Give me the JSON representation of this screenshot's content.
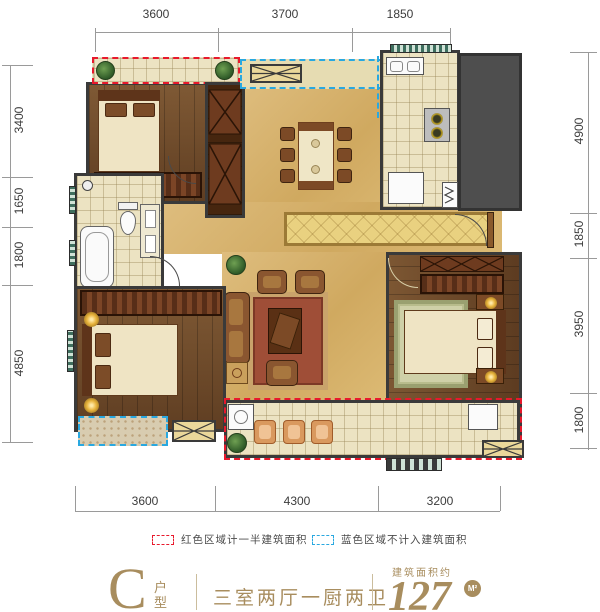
{
  "dimensions": {
    "top": [
      "3600",
      "3700",
      "1850"
    ],
    "left": [
      "3400",
      "1650",
      "1800",
      "4850"
    ],
    "right": [
      "4900",
      "1850",
      "3950",
      "1800"
    ],
    "bottom": [
      "3600",
      "4300",
      "3200"
    ]
  },
  "legend": {
    "red_label": "红色区域计一半建筑面积",
    "blue_label": "蓝色区域不计入建筑面积",
    "red_color": "#e8192c",
    "blue_color": "#29a8e0"
  },
  "title": {
    "letter": "C",
    "letter_suffix": "户型",
    "rooms": "三室两厅一厨两卫",
    "area_label": "建筑面积约",
    "area_value": "127",
    "area_unit": "M²",
    "accent_color": "#a88d5e"
  },
  "colors": {
    "wall": "#3a3a3a",
    "wood_floor": "#6d4727",
    "marble_floor": "#d8b471",
    "tile_floor": "#ece3c2"
  }
}
